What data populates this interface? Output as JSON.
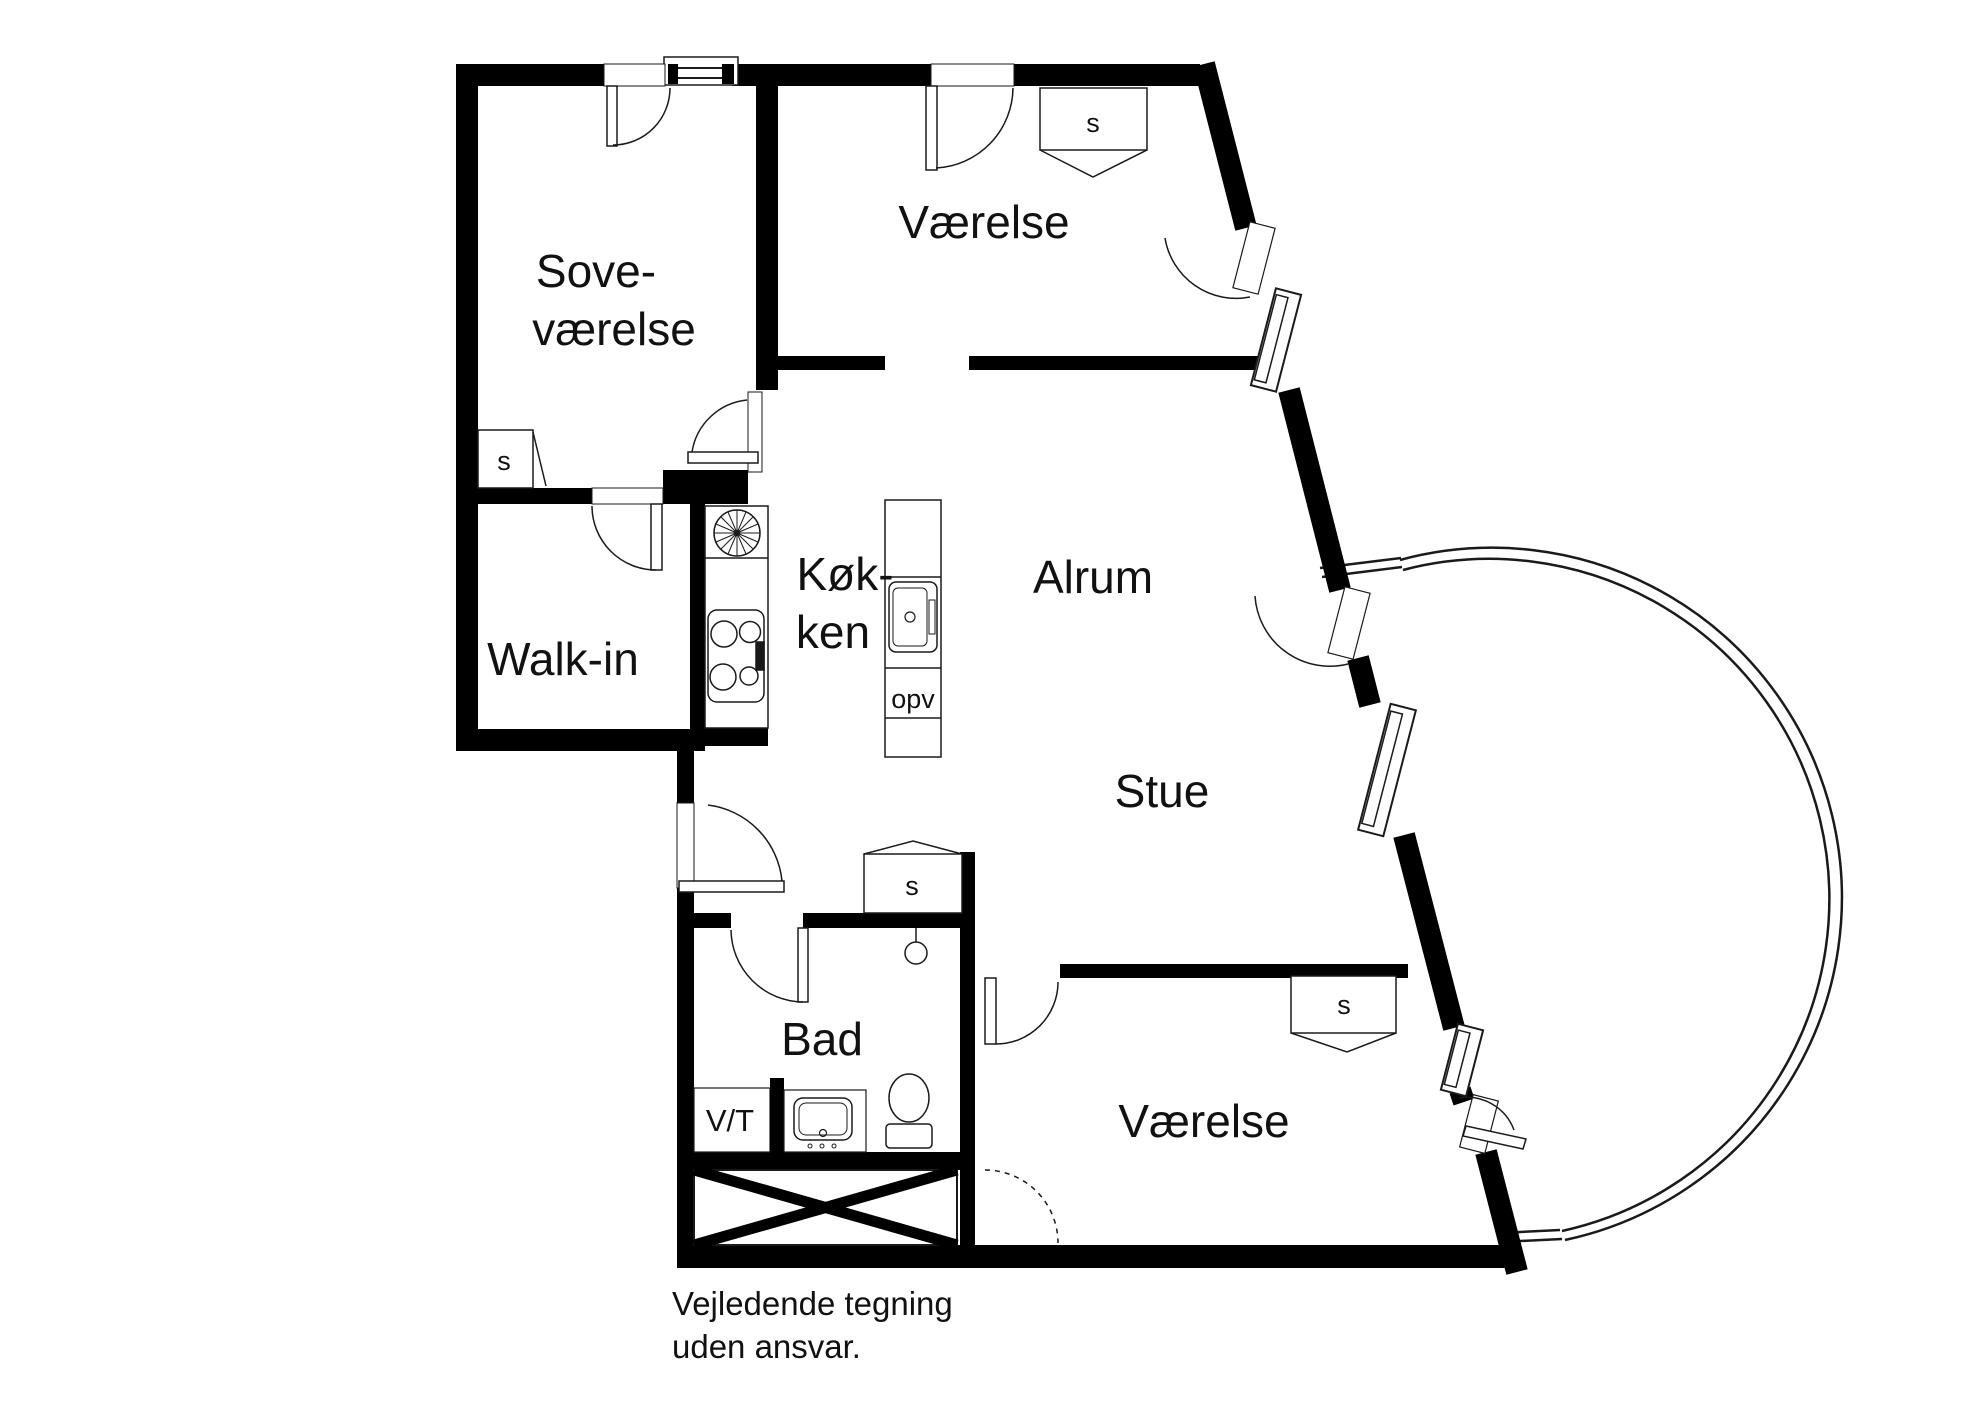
{
  "rooms": {
    "sovevaerelse": {
      "line1": "Sove-",
      "line2": "værelse"
    },
    "vaerelse_top": {
      "label": "Værelse"
    },
    "walk_in": {
      "label": "Walk-in"
    },
    "koekken": {
      "line1": "Køk-",
      "line2": "ken"
    },
    "alrum": {
      "label": "Alrum"
    },
    "stue": {
      "label": "Stue"
    },
    "bad": {
      "label": "Bad"
    },
    "vaerelse_bottom": {
      "label": "Værelse"
    }
  },
  "closets": {
    "sovevaerelse": "s",
    "vaerelse_top": "s",
    "stue": "s",
    "vaerelse_bottom": "s"
  },
  "fixtures": {
    "dishwasher_island": "opv",
    "washer_dryer": "V/T"
  },
  "footer": {
    "line1": "Vejledende tegning",
    "line2": "uden ansvar."
  },
  "colors": {
    "wall": "#000000",
    "line": "#1a1a1a",
    "text": "#111111",
    "background": "#ffffff"
  }
}
